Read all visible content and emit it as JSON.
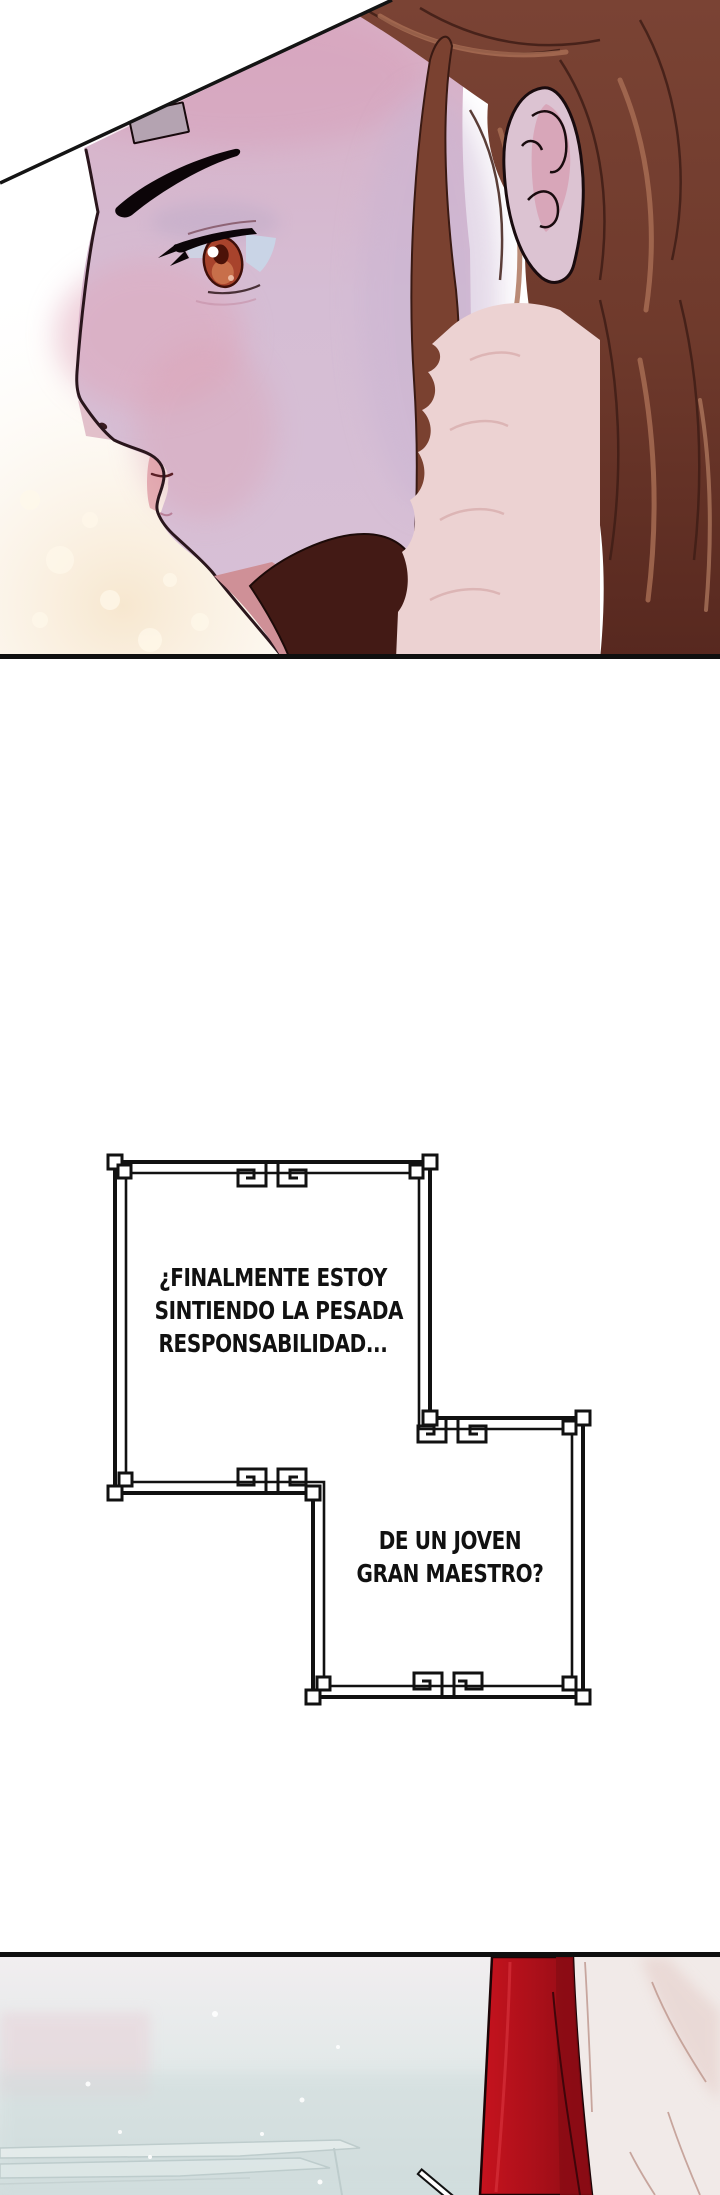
{
  "page": {
    "kind": "webtoon comic page",
    "background": "#ffffff",
    "panel_border_color": "#0f0f0f"
  },
  "speech_box": {
    "frame_color": "#111111",
    "text_color": "#111111",
    "bubble1_lines": [
      "¿FINALMENTE ESTOY",
      "SINTIENDO LA PESADA",
      "RESPONSABILIDAD..."
    ],
    "bubble2_lines": [
      "DE UN JOVEN",
      "GRAN MAESTRO?"
    ]
  },
  "panel_portrait": {
    "label": "close-up side profile of a brown-haired character",
    "palette": {
      "skin": "#d8c0d6",
      "skin_top": "#d9aec4",
      "blush": "#dfa3b8",
      "hair": "#7a4334",
      "hair_dark": "#57281f",
      "hair_highlight": "#aa6f55",
      "eye_iris": "#a8432c",
      "fur_collar": "#ecd2d2",
      "under_chin_shadow": "#431a15",
      "background_glow": "#f7e7cf",
      "outline": "#17090c",
      "bandage": "#b4a3b1"
    }
  },
  "panel_bottom": {
    "label": "misty hall with red drape and white robe",
    "palette": {
      "mist_top": "#f2eef0",
      "mist_bottom": "#d2dede",
      "pink_haze": "#e8d4da",
      "red_robe": "#c6131e",
      "red_robe_dark": "#8a0b13",
      "white_robe": "#f1eae8",
      "steps": "#e8efee",
      "outline": "#1c0406"
    }
  }
}
